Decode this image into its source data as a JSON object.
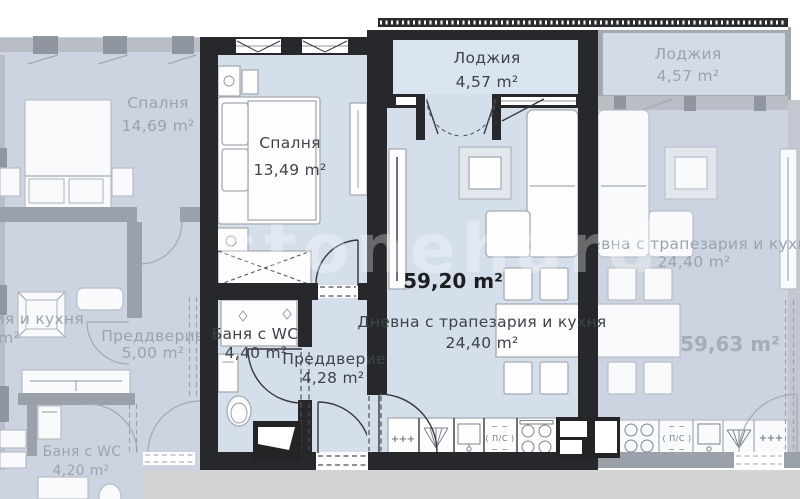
{
  "fp": {
    "watermark": "stonehard",
    "icons": {
      "plus": "+",
      "tilde": "~ ~"
    },
    "main": {
      "total": "59,20 m²",
      "loggia": {
        "name": "Лоджия",
        "area": "4,57 m²"
      },
      "bedroom": {
        "name": "Спалня",
        "area": "13,49 m²"
      },
      "bath": {
        "name": "Баня с WC",
        "area": "4,40 m²"
      },
      "hall": {
        "name": "Преддверие",
        "area": "4,28 m²"
      },
      "living": {
        "name": "Дневна с трапезария и кухня",
        "area": "24,40 m²"
      },
      "appliance": "( П/С )"
    },
    "left": {
      "bedroom": {
        "name": "Спалня",
        "area": "14,69 m²"
      },
      "hall": {
        "name": "Преддверие",
        "area": "5,00 m²"
      },
      "bath": {
        "name": "Баня с WC",
        "area": "4,20 m²"
      },
      "living": {
        "name": "Дневна с трапезария и кухня",
        "area": "24,40 m²"
      }
    },
    "right": {
      "total": "59,63 m²",
      "loggia": {
        "name": "Лоджия",
        "area": "4,57 m²"
      },
      "living": {
        "name": "Дневна с трапезария и кухня",
        "area": "24,40 m²"
      },
      "appliance": "( П/С )"
    }
  }
}
